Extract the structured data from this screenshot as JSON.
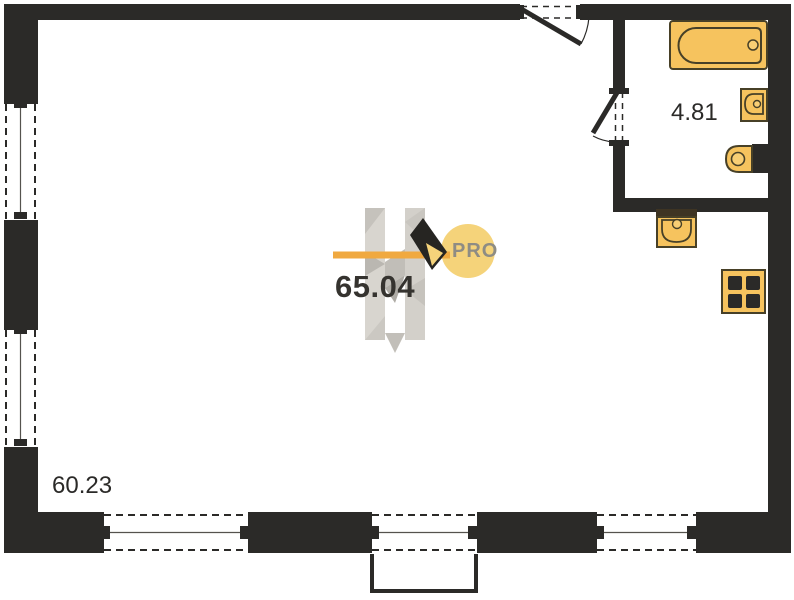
{
  "labels": {
    "main_area": "65.04",
    "bathroom_area": "4.81",
    "secondary_area": "60.23"
  },
  "watermark": {
    "badge": "PRO"
  },
  "rooms": [
    {
      "name": "main-room",
      "area": "65.04"
    },
    {
      "name": "bathroom",
      "area": "4.81"
    },
    {
      "name": "lower-zone",
      "area": "60.23"
    }
  ],
  "fixtures": [
    {
      "icon": "bathtub-icon"
    },
    {
      "icon": "washbasin-icon"
    },
    {
      "icon": "toilet-icon"
    },
    {
      "icon": "kitchen-sink-icon"
    },
    {
      "icon": "stove-icon"
    }
  ],
  "colors": {
    "wall": "#2b2a28",
    "fixture_fill": "#f6c35e",
    "fixture_stroke": "#474027",
    "accent_orange_bar": "#f0a940",
    "badge_circle": "#f5d37a",
    "watermark_gray": "#d6d3cd",
    "label_text": "#2b2a28"
  }
}
